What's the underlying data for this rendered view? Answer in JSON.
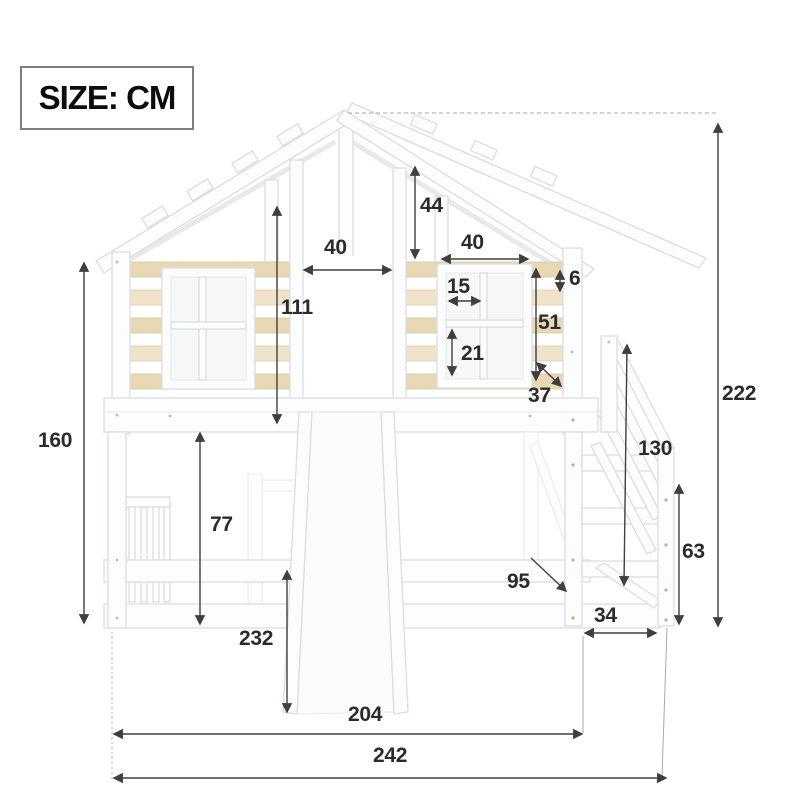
{
  "header": {
    "size_label": "SIZE: CM"
  },
  "dims": {
    "d44": "44",
    "d40a": "40",
    "d40b": "40",
    "d15": "15",
    "d21": "21",
    "d51": "51",
    "d6": "6",
    "d37": "37",
    "d111": "111",
    "d160": "160",
    "d77": "77",
    "d232": "232",
    "d130": "130",
    "d63": "63",
    "d95": "95",
    "d34": "34",
    "d204": "204",
    "d242": "242",
    "d222": "222"
  },
  "colors": {
    "wood_slat": "#e9d8b4",
    "wood_slat_light": "#efe3c9",
    "structure_outline": "#d9dee2",
    "dimension_line": "#3f3f3f",
    "label_text": "#2b2b2b",
    "background": "#ffffff"
  }
}
